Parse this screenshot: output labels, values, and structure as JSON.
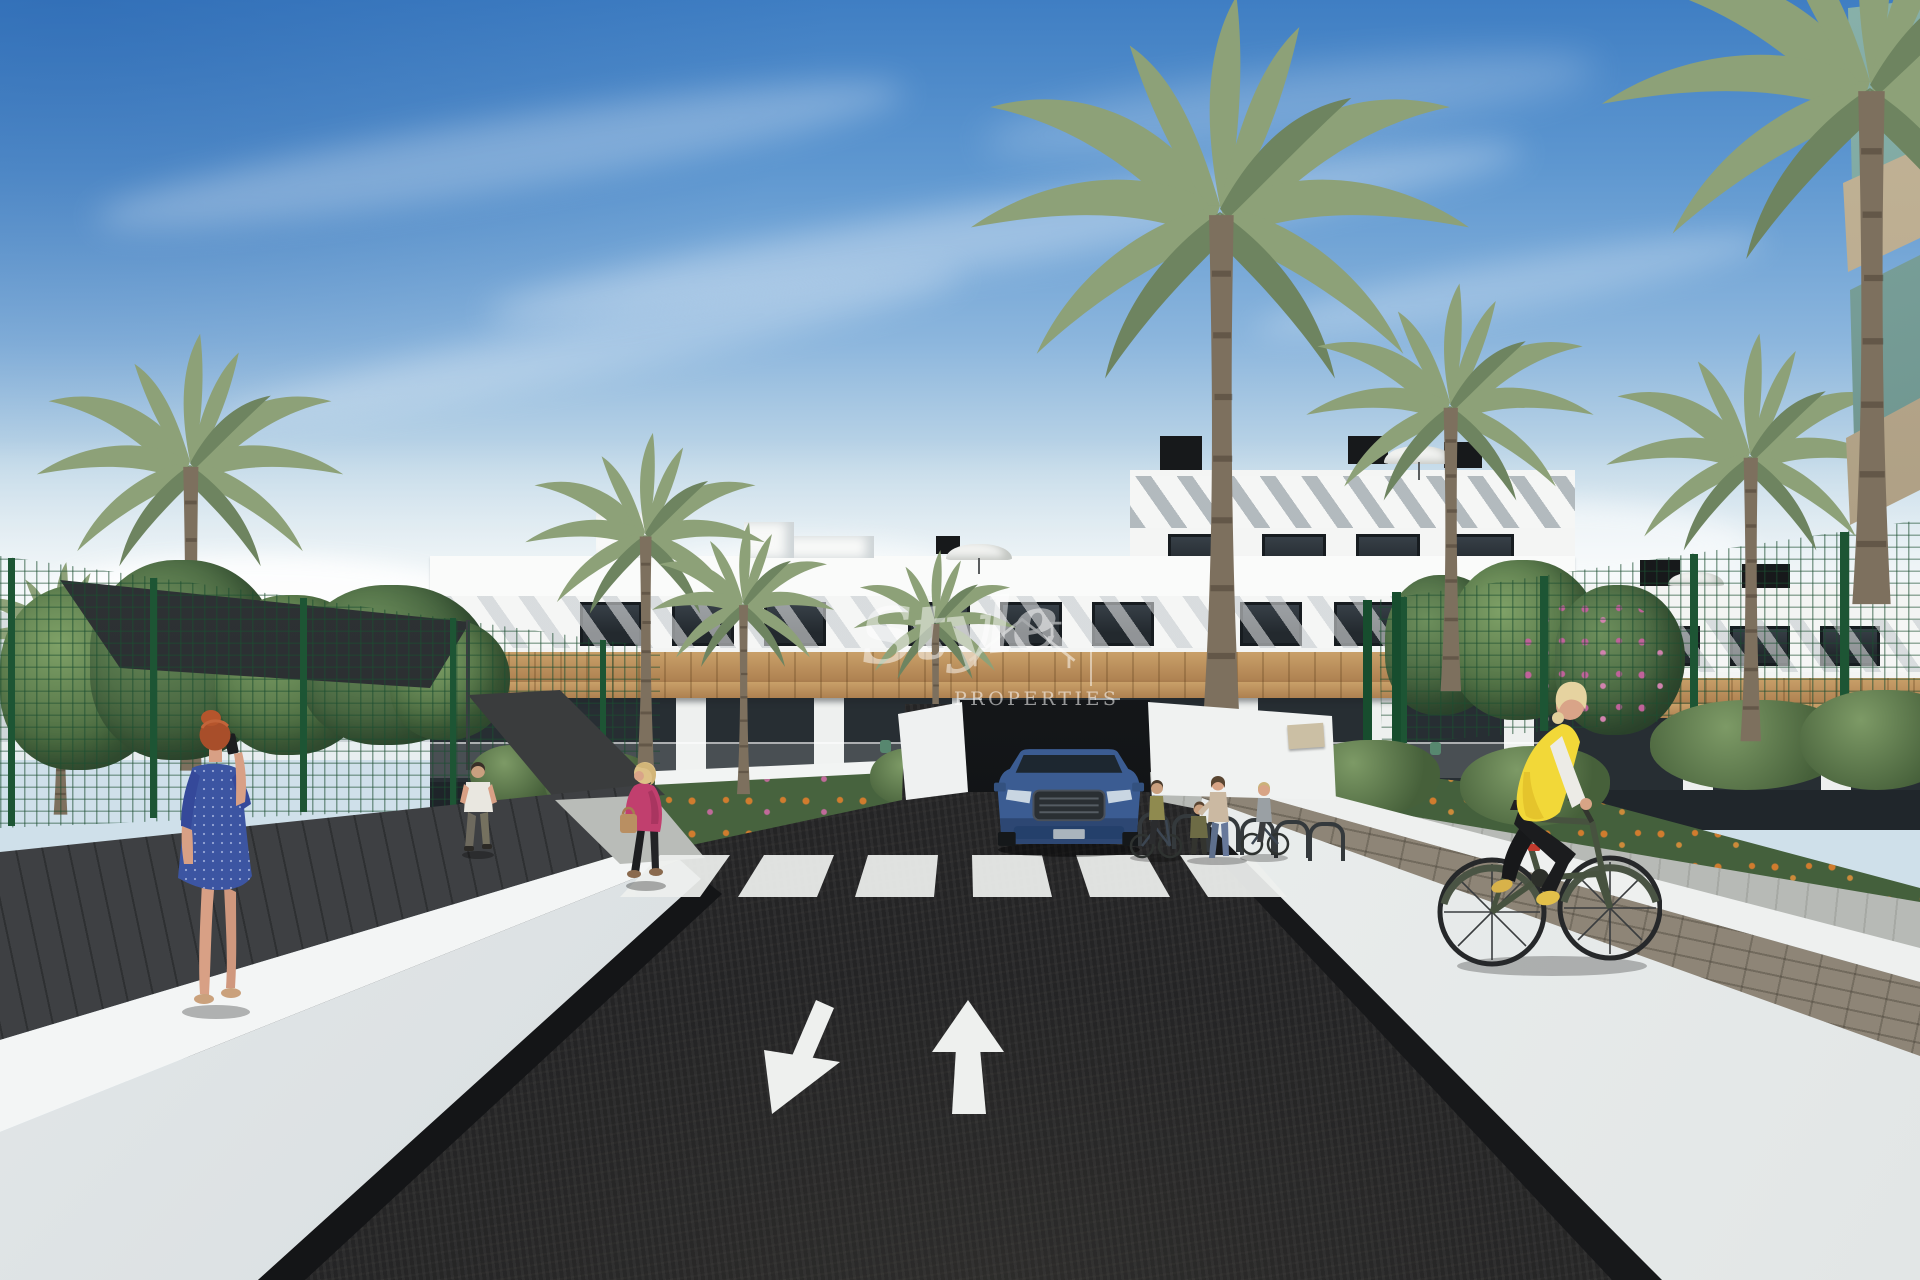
{
  "watermark": {
    "script": "Style",
    "caps": "PROPERTIES",
    "icon": "house-outline-icon"
  },
  "icons": {
    "house": "house-outline-icon",
    "arrow_up": "up-arrow-road-marking",
    "arrow_down_left": "down-left-arrow-road-marking",
    "crosswalk": "zebra-crossing-marking"
  },
  "colors": {
    "sky_top": "#3f7ec3",
    "sky_horizon": "#e4edf0",
    "building_white": "#f4f5f4",
    "stripe_shadow": "#a7afb4",
    "wood": "#b98f5c",
    "window_dark": "#2c3338",
    "fence_green": "#1d5534",
    "palm_green": "#8da178",
    "palm_green_dark": "#6e8460",
    "trunk": "#7d705e",
    "foliage_dark": "#3f5c3a",
    "asphalt": "#262627",
    "wall_white": "#eef0f0",
    "paver_gray": "#b7bab6",
    "brick_path": "#8e8577",
    "marking": "#eef0ee",
    "car_blue": "#3b5c92",
    "vest_yellow": "#f2d838",
    "jacket_pink": "#c13f6e",
    "dress_blue": "#3c55a2",
    "hair_red": "#a84e2a",
    "glass": "#86aca4",
    "soffit": "#b5a68b",
    "sail": "#2f3336"
  }
}
